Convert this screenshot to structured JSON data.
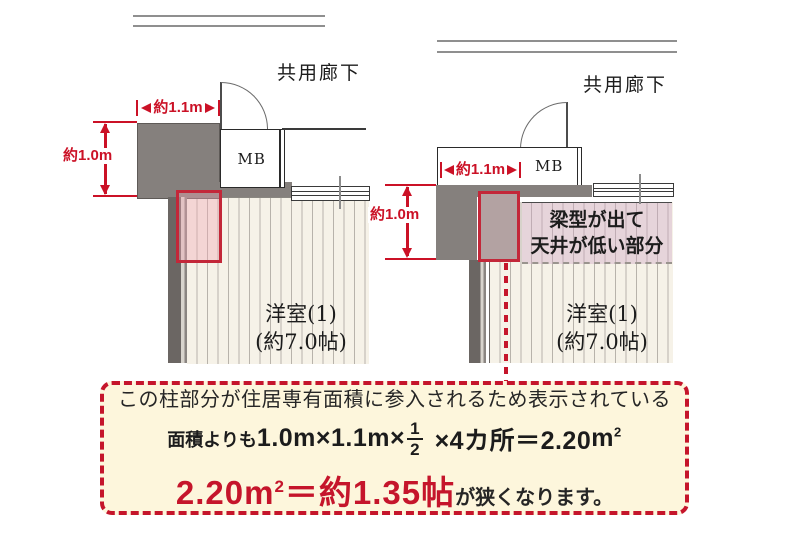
{
  "left_plan": {
    "corridor_label": "共用廊下",
    "width_dim": "約1.1m",
    "height_dim": "約1.0m",
    "mb_label": "MB",
    "room_name": "洋室(1)",
    "room_size": "(約7.0帖)"
  },
  "right_plan": {
    "corridor_label": "共用廊下",
    "width_dim": "約1.1m",
    "height_dim": "約1.0m",
    "mb_label": "MB",
    "room_name": "洋室(1)",
    "room_size": "(約7.0帖)",
    "beam_note_line1": "梁型が出て",
    "beam_note_line2": "天井が低い部分"
  },
  "note_box": {
    "line1": "この柱部分が住居専有面積に参入されるため表示されている",
    "line2_prefix": "面積よりも",
    "line2_formula_a": "1.0m×1.1m×",
    "fraction_num": "1",
    "fraction_den": "2",
    "line2_formula_b": "×4カ所＝2.20",
    "sqm_base": "m",
    "sqm_sup": "2",
    "line3_red_value": "2.20",
    "line3_red_rest": "＝約1.35帖",
    "line3_suffix": "が狭くなります。"
  },
  "colors": {
    "accent_red": "#cb1126",
    "highlight_border_red": "#c32739",
    "note_red": "#c5152b",
    "wall_gray": "#85807d",
    "note_bg": "#fdf6dc"
  }
}
